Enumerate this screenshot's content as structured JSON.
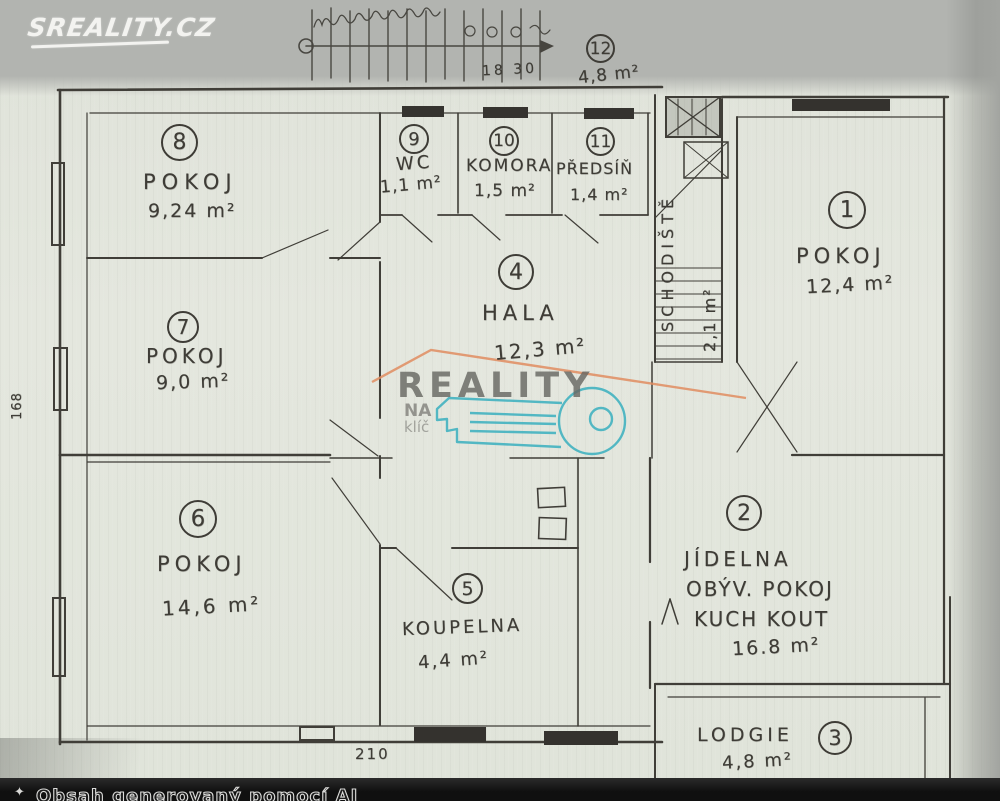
{
  "watermarks": {
    "sreality_logo": "SREALITY.CZ",
    "reality": "REALITY",
    "na": "NA",
    "klic": "klíč"
  },
  "footer": {
    "ai_notice": "Obsah generovaný pomocí AI",
    "icon": "sparkle-icon"
  },
  "plan": {
    "rooms": [
      {
        "number": "1",
        "name": "POKOJ",
        "area": "12,4 m²"
      },
      {
        "number": "2",
        "name": "JÍDELNA",
        "name2": "OBÝV. POKOJ",
        "name3": "KUCH KOUT",
        "area": "16.8 m²"
      },
      {
        "number": "3",
        "name": "LODGIE",
        "area": "4,8 m²"
      },
      {
        "number": "4",
        "name": "HALA",
        "area": "12,3 m²"
      },
      {
        "number": "5",
        "name": "KOUPELNA",
        "area": "4,4 m²"
      },
      {
        "number": "6",
        "name": "POKOJ",
        "area": "14,6 m²"
      },
      {
        "number": "7",
        "name": "POKOJ",
        "area": "9,0 m²"
      },
      {
        "number": "8",
        "name": "POKOJ",
        "area": "9,24 m²"
      },
      {
        "number": "9",
        "name": "WC",
        "area": "1,1 m²"
      },
      {
        "number": "10",
        "name": "KOMORA",
        "area": "1,5 m²"
      },
      {
        "number": "11",
        "name": "PŘEDSÍŇ",
        "area": "1,4 m²"
      },
      {
        "number": "12",
        "area": "4,8 m²"
      }
    ],
    "staircase": {
      "label": "SCHODIŠTĚ",
      "area": "2,1 m²"
    },
    "dimensions": {
      "stair": "18 30",
      "bottom": "210",
      "left": "168"
    }
  }
}
